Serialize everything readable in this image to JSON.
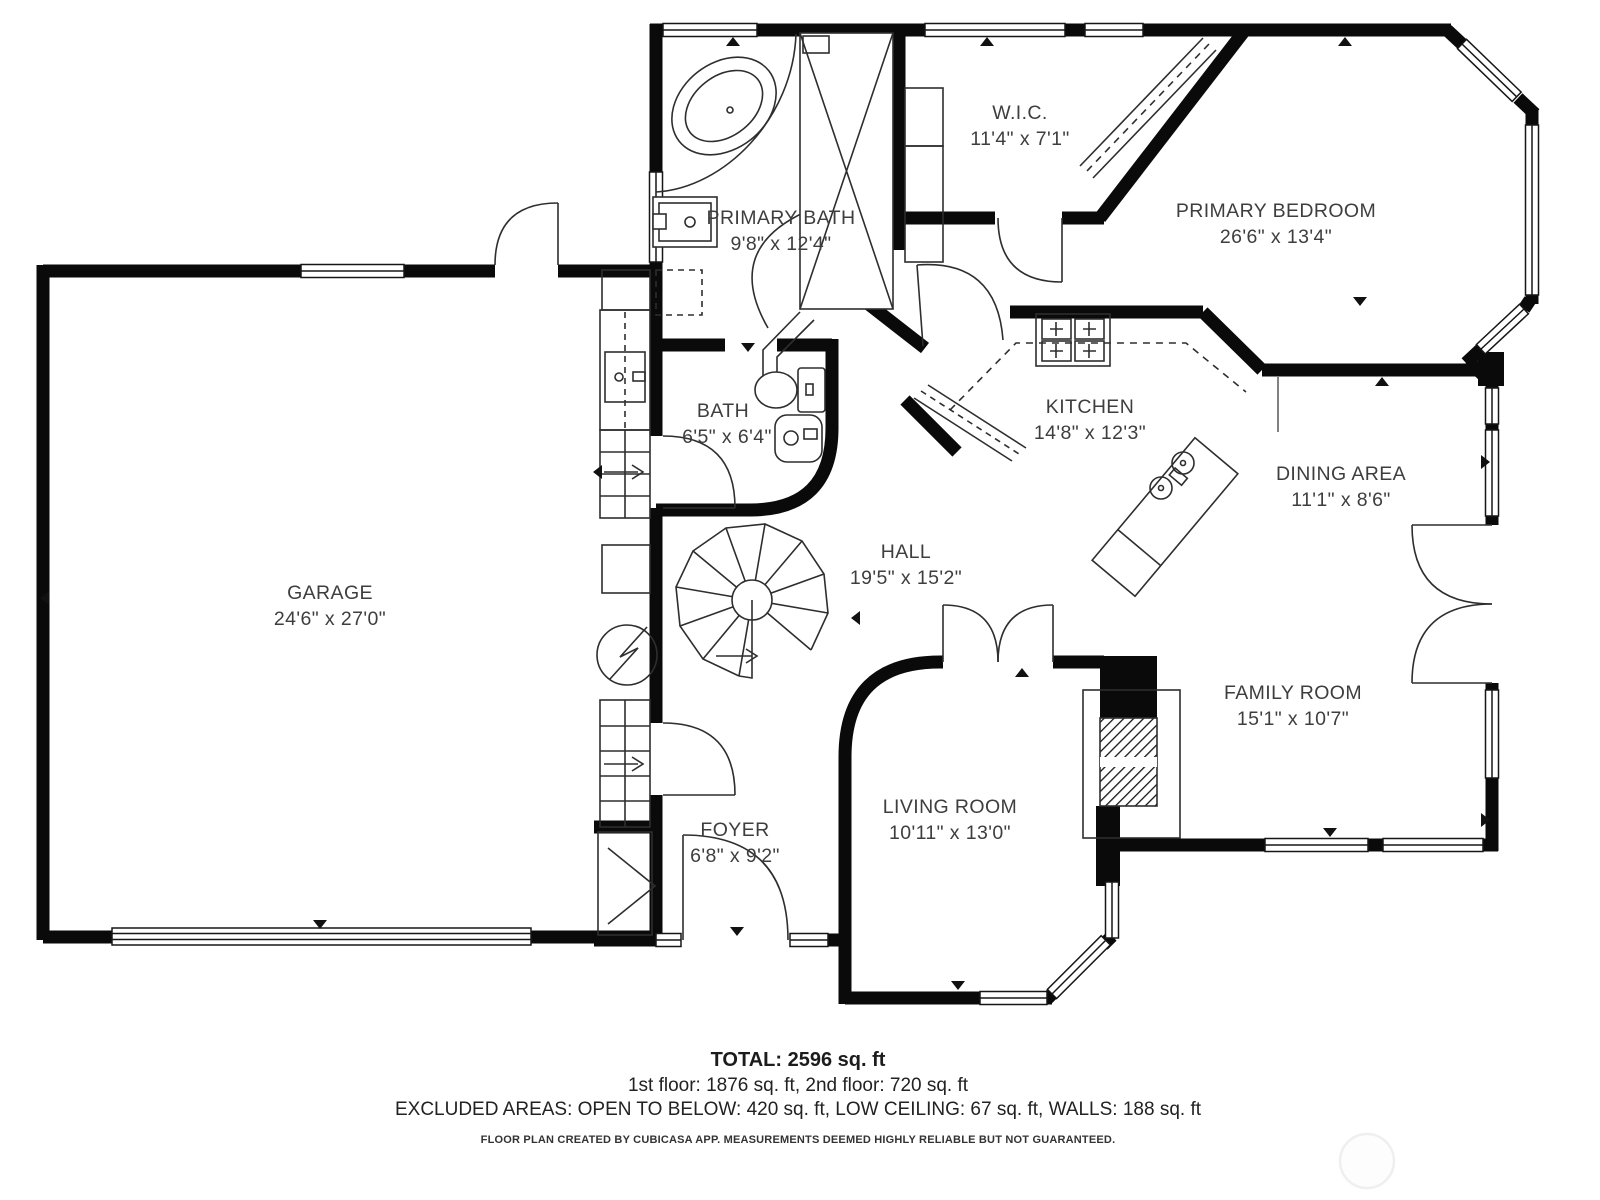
{
  "plan": {
    "creator_note": "FLOOR PLAN CREATED BY CUBICASA APP. MEASUREMENTS DEEMED HIGHLY RELIABLE BUT NOT GUARANTEED.",
    "total": "TOTAL: 2596 sq. ft",
    "floors": "1st floor: 1876 sq. ft, 2nd floor: 720 sq. ft",
    "excluded": "EXCLUDED AREAS: OPEN TO BELOW: 420 sq. ft, LOW CEILING: 67 sq. ft, WALLS: 188 sq. ft"
  },
  "rooms": [
    {
      "id": "garage",
      "name": "GARAGE",
      "dims": "24'6\" x 27'0\""
    },
    {
      "id": "primary-bath",
      "name": "PRIMARY BATH",
      "dims": "9'8\" x 12'4\""
    },
    {
      "id": "wic",
      "name": "W.I.C.",
      "dims": "11'4\" x 7'1\""
    },
    {
      "id": "primary-bedroom",
      "name": "PRIMARY BEDROOM",
      "dims": "26'6\" x 13'4\""
    },
    {
      "id": "bath",
      "name": "BATH",
      "dims": "6'5\" x 6'4\""
    },
    {
      "id": "kitchen",
      "name": "KITCHEN",
      "dims": "14'8\" x 12'3\""
    },
    {
      "id": "dining-area",
      "name": "DINING AREA",
      "dims": "11'1\" x 8'6\""
    },
    {
      "id": "hall",
      "name": "HALL",
      "dims": "19'5\" x 15'2\""
    },
    {
      "id": "family-room",
      "name": "FAMILY ROOM",
      "dims": "15'1\" x 10'7\""
    },
    {
      "id": "living-room",
      "name": "LIVING ROOM",
      "dims": "10'11\" x 13'0\""
    },
    {
      "id": "foyer",
      "name": "FOYER",
      "dims": "6'8\" x 9'2\""
    }
  ],
  "colors": {
    "wall": "#0a0a0a",
    "line": "#2e2e2e",
    "text": "#3e3e3e"
  }
}
